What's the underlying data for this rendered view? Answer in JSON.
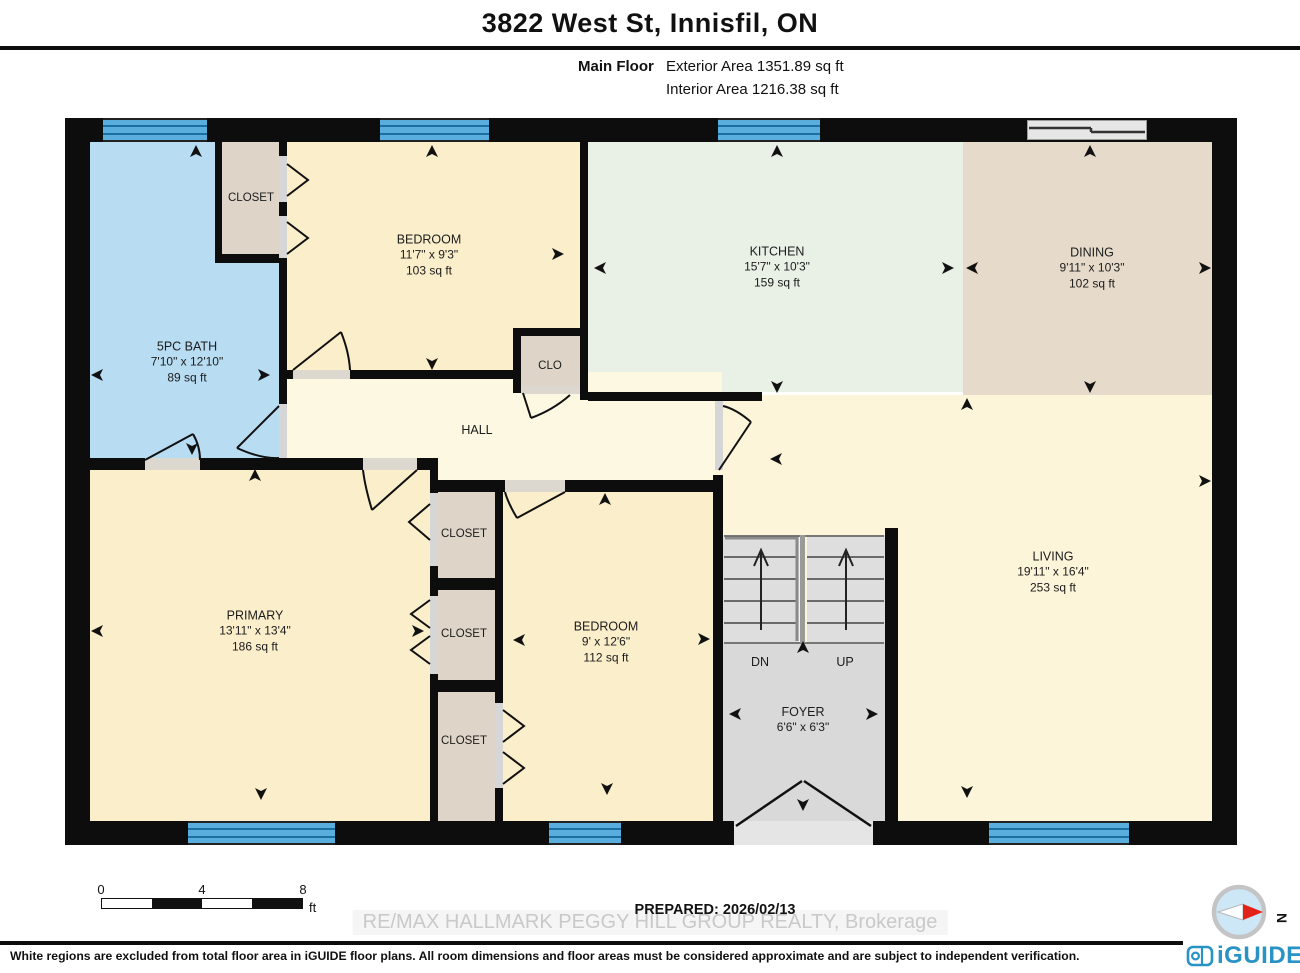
{
  "header": {
    "title": "3822 West St, Innisfil, ON",
    "floor_label": "Main Floor",
    "exterior_area": "Exterior Area 1351.89 sq ft",
    "interior_area": "Interior Area 1216.38 sq ft"
  },
  "rooms": {
    "bath": {
      "name": "5PC BATH",
      "dims": "7'10\" x 12'10\"",
      "area": "89 sq ft"
    },
    "bedroom_top": {
      "name": "BEDROOM",
      "dims": "11'7\" x 9'3\"",
      "area": "103 sq ft"
    },
    "kitchen": {
      "name": "KITCHEN",
      "dims": "15'7\" x 10'3\"",
      "area": "159 sq ft"
    },
    "dining": {
      "name": "DINING",
      "dims": "9'11\" x 10'3\"",
      "area": "102 sq ft"
    },
    "primary": {
      "name": "PRIMARY",
      "dims": "13'11\" x 13'4\"",
      "area": "186 sq ft"
    },
    "bedroom2": {
      "name": "BEDROOM",
      "dims": "9' x 12'6\"",
      "area": "112 sq ft"
    },
    "living": {
      "name": "LIVING",
      "dims": "19'11\" x 16'4\"",
      "area": "253 sq ft"
    },
    "foyer": {
      "name": "FOYER",
      "dims": "6'6\" x 6'3\""
    }
  },
  "labels": {
    "hall": "HALL",
    "closet": "CLOSET",
    "clo": "CLO",
    "dn": "DN",
    "up": "UP",
    "north": "N"
  },
  "footer": {
    "scale": {
      "t0": "0",
      "t4": "4",
      "t8": "8",
      "unit": "ft"
    },
    "prepared": "PREPARED: 2026/02/13",
    "watermark": "RE/MAX HALLMARK PEGGY HILL GROUP REALTY, Brokerage",
    "disclaimer": "White regions are excluded from total floor area in iGUIDE floor plans. All room dimensions and floor areas must be considered approximate and are subject to independent verification.",
    "brand": "iGUIDE"
  },
  "colors": {
    "wall": "#0d0d0d",
    "window_blue": "#5aaede",
    "bath": "#b8dcf2",
    "bedroom": "#fbeecb",
    "kitchen": "#e9f1e7",
    "dining": "#e6dbca",
    "hall": "#fdf8e2",
    "living": "#fcf5d9",
    "closet": "#ded5c8",
    "stairs": "#dedede",
    "foyer": "#d9d9d9",
    "brand_blue": "#2a93c5",
    "compass_red": "#e32219"
  }
}
